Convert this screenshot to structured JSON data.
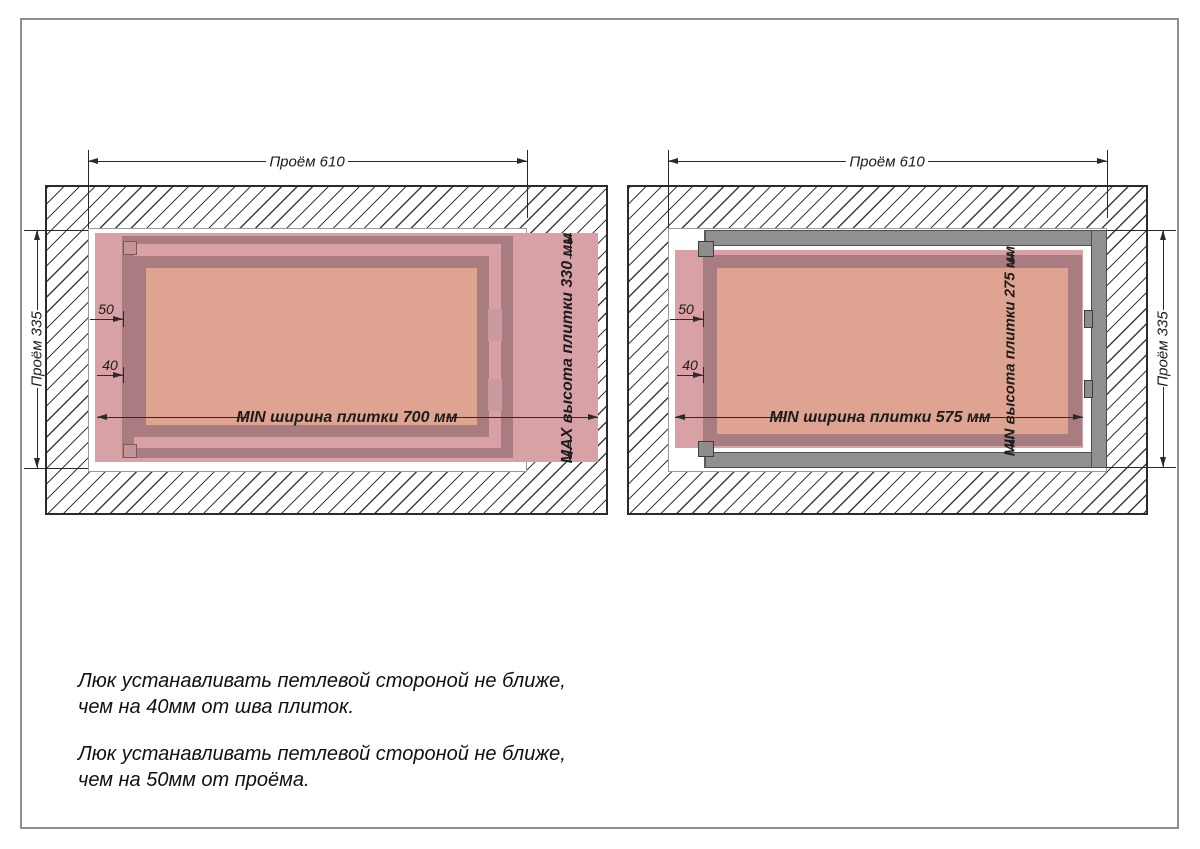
{
  "page": {
    "border_color": "#8f8f8f",
    "background": "#ffffff"
  },
  "colors": {
    "tile_pink": "#d7a1a5",
    "hatch_frame_dark": "#a87c80",
    "hatch_door_salmon": "#dfa391",
    "steel_frame_gray": "#909090",
    "dimension_line": "#2a2a2a"
  },
  "diagram_left": {
    "dim_opening_width": "Проём 610",
    "dim_opening_height": "Проём 335",
    "dim_offset_opening": "50",
    "dim_offset_seam": "40",
    "dim_tile_min_width": "MIN ширина плитки 700 мм",
    "dim_tile_max_height": "MAX высота плитки 330 мм"
  },
  "diagram_right": {
    "dim_opening_width": "Проём 610",
    "dim_opening_height": "Проём 335",
    "dim_offset_opening": "50",
    "dim_offset_seam": "40",
    "dim_tile_min_width": "MIN ширина плитки 575 мм",
    "dim_tile_min_height": "MIN высота плитки 275 мм"
  },
  "notes": {
    "note_seam": "Люк устанавливать петлевой стороной не ближе,\n чем на 40мм от шва плиток.",
    "note_opening": "Люк устанавливать петлевой стороной не ближе,\n чем на 50мм от проёма."
  }
}
